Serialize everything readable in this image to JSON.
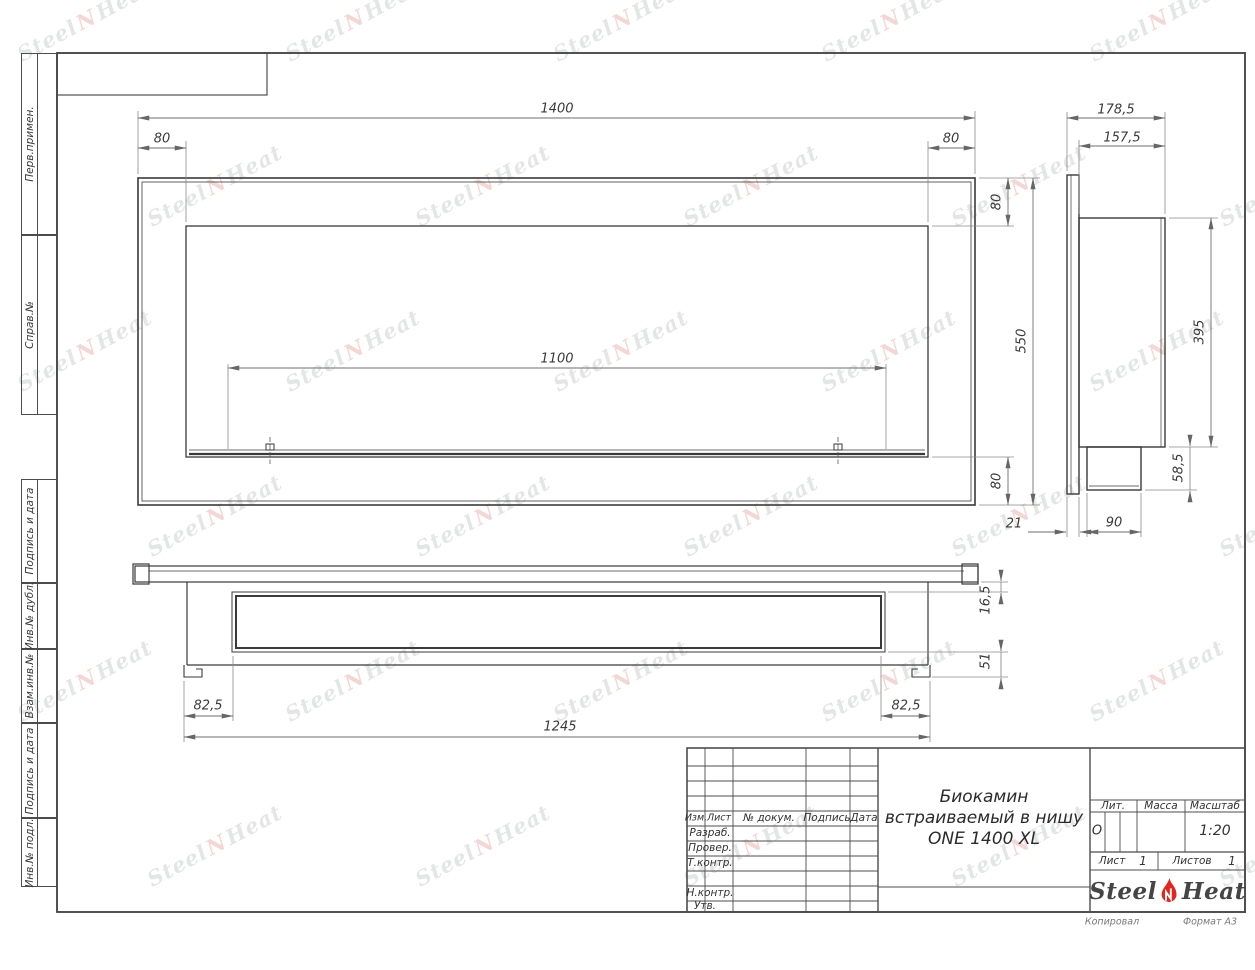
{
  "margin": {
    "labels": [
      "Перв.примен.",
      "Справ.№",
      "Подпись и дата",
      "Инв.№ дубл.",
      "Взам.инв.№",
      "Подпись и дата",
      "Инв.№ подл."
    ]
  },
  "front_view": {
    "dims": {
      "total_width": "1400",
      "left_offset": "80",
      "right_offset": "80",
      "opening_width": "1100",
      "top_offset": "80",
      "height": "550",
      "bottom_offset": "80"
    }
  },
  "side_view": {
    "dims": {
      "total_depth": "178,5",
      "body_depth": "157,5",
      "body_height": "395",
      "burner_height": "58,5",
      "flange_depth": "21",
      "burner_depth": "90"
    }
  },
  "bottom_view": {
    "dims": {
      "left_offset": "82,5",
      "right_offset": "82,5",
      "base_length": "1245",
      "top_inset": "16,5",
      "side_height": "51"
    }
  },
  "title_block": {
    "header_columns": [
      "Изм.",
      "Лист",
      "№ докум.",
      "Подпись",
      "Дата"
    ],
    "row_labels": [
      "Разраб.",
      "Провер.",
      "Т.контр.",
      "Н.контр.",
      "Утв."
    ],
    "title_line1": "Биокамин",
    "title_line2": "встраиваемый в нишу",
    "title_line3": "ONE 1400 XL",
    "lit_label": "Лит.",
    "lit_value": "О",
    "mass_label": "Масса",
    "scale_label": "Масштаб",
    "scale_value": "1:20",
    "sheet_label": "Лист",
    "sheet_value": "1",
    "sheets_label": "Листов",
    "sheets_value": "1",
    "footer_left": "Копировал",
    "footer_right": "Формат А3"
  },
  "logo": {
    "word1": "Steel",
    "word2": "Heat"
  },
  "watermark": {
    "word1": "Steel",
    "word2": "Heat"
  },
  "colors": {
    "line": "#3a3a3a",
    "dim_line": "#6e6e6e",
    "accent_red": "#e3241f"
  }
}
